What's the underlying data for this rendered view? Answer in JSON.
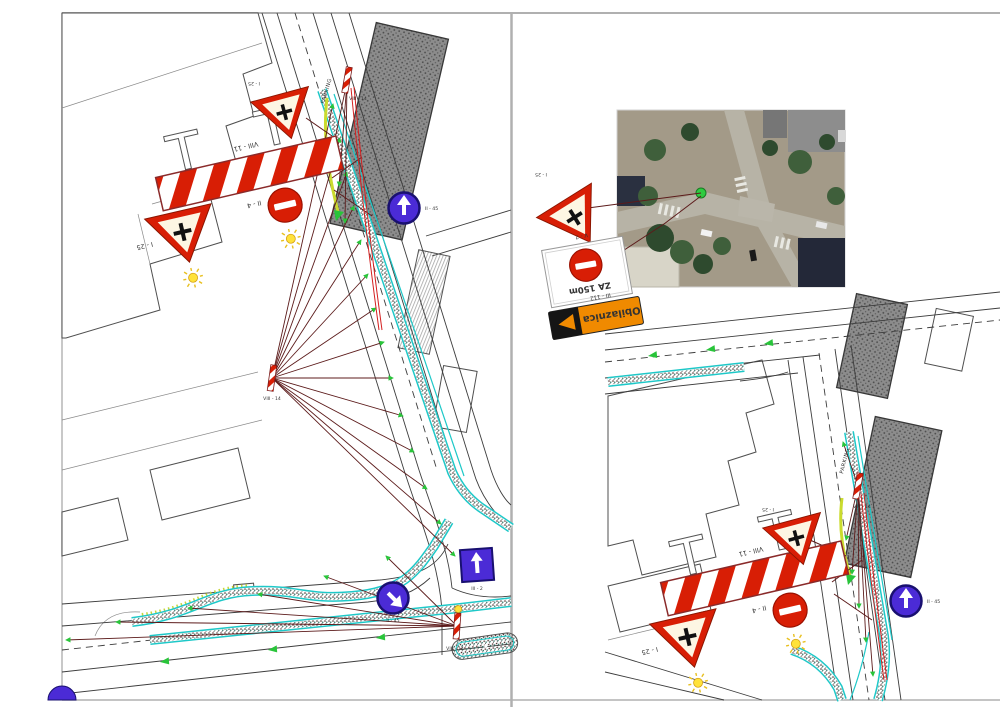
{
  "sheet": {
    "background": "#ffffff",
    "frame_color": "#b0b0b0",
    "panel_count": "2"
  },
  "labels": {
    "road_name": "PARKING"
  },
  "signs": {
    "barrier_fence": {
      "code": "VIII - 11"
    },
    "warning_triangle": {
      "code": "I - 25"
    },
    "no_entry": {
      "code": "II - 4"
    },
    "delineator_post": {
      "code": "VIII - 14"
    },
    "closure_board": {
      "code": "V - 7",
      "text": "ZA 150m"
    },
    "detour_arrow": {
      "code": "III - 112",
      "text": "Obilaznica"
    },
    "one_way": {
      "code": "III - 2"
    },
    "mandatory_direction": {
      "code": "II - 45"
    }
  },
  "colors": {
    "sign_red": "#d81e05",
    "sign_blue": "#4b2bd6",
    "detour_orange": "#f08a00",
    "lamp_yellow": "#ffe23a",
    "leader_maroon": "#5c1b1b",
    "curb_cyan": "#1ec8c8",
    "marker_green": "#2ecc40",
    "building_gray": "#8c8c8c"
  }
}
